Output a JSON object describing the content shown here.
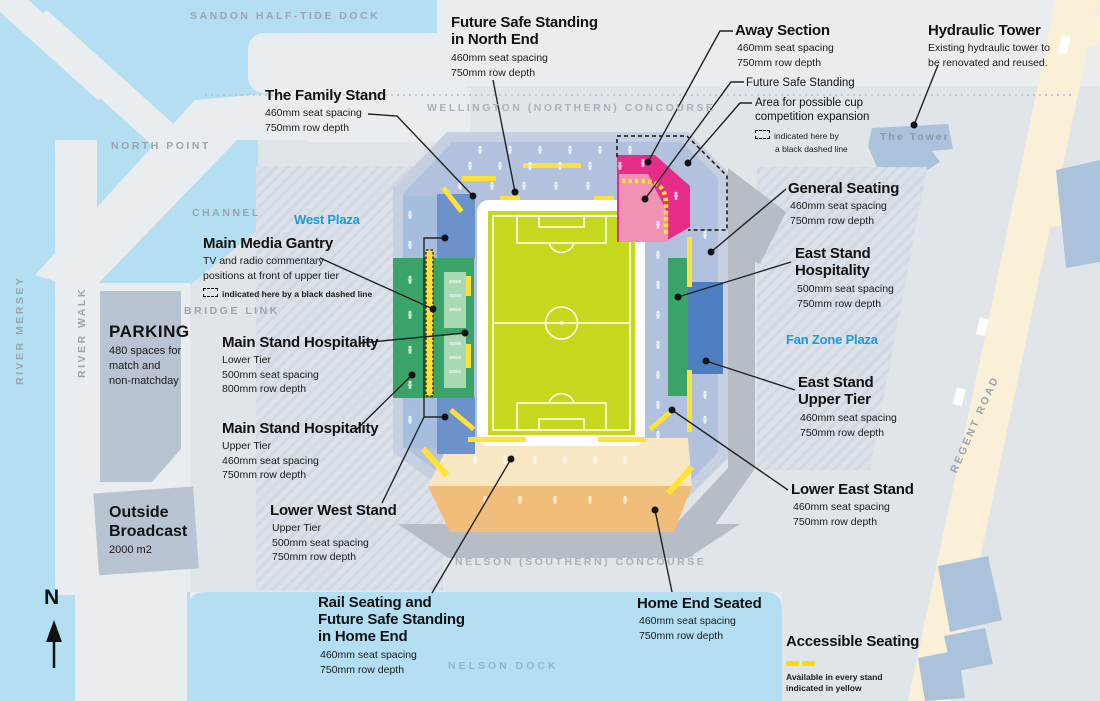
{
  "map_labels": {
    "sandon_dock": "SANDON HALF-TIDE DOCK",
    "north_point": "NORTH POINT",
    "channel": "CHANNEL",
    "bridge_link": "BRIDGE LINK",
    "river_mersey": "RIVER MERSEY",
    "river_walk": "RIVER WALK",
    "wellington_concourse": "WELLINGTON (NORTHERN) CONCOURSE",
    "nelson_concourse": "NELSON (SOUTHERN) CONCOURSE",
    "nelson_dock": "NELSON DOCK",
    "the_tower": "The Tower",
    "regent_road": "REGENT ROAD",
    "west_plaza": "West Plaza",
    "fan_zone_plaza": "Fan Zone Plaza",
    "compass_north": "N"
  },
  "callouts": {
    "future_safe_standing_north": {
      "title_lines": [
        "Future Safe Standing",
        "in North End"
      ],
      "details": [
        "460mm seat spacing",
        "750mm row depth"
      ]
    },
    "family_stand": {
      "title_lines": [
        "The Family Stand"
      ],
      "details": [
        "460mm seat spacing",
        "750mm row depth"
      ]
    },
    "away_section": {
      "title_lines": [
        "Away Section"
      ],
      "details": [
        "460mm seat spacing",
        "750mm row depth"
      ]
    },
    "future_safe_standing": {
      "title_lines": [
        "Future Safe Standing"
      ]
    },
    "cup_expansion": {
      "title_lines": [
        "Area for possible cup",
        "competition expansion"
      ],
      "note_lines": [
        "indicated here by",
        "a black dashed line"
      ]
    },
    "hydraulic_tower": {
      "title_lines": [
        "Hydraulic Tower"
      ],
      "details": [
        "Existing hydraulic tower to",
        "be renovated and reused."
      ]
    },
    "general_seating": {
      "title_lines": [
        "General Seating"
      ],
      "details": [
        "460mm seat spacing",
        "750mm row depth"
      ]
    },
    "east_stand_hospitality": {
      "title_lines": [
        "East Stand",
        "Hospitality"
      ],
      "details": [
        "500mm seat spacing",
        "750mm row depth"
      ]
    },
    "east_stand_upper": {
      "title_lines": [
        "East Stand",
        "Upper Tier"
      ],
      "details": [
        "460mm seat spacing",
        "750mm row depth"
      ]
    },
    "lower_east_stand": {
      "title_lines": [
        "Lower East Stand"
      ],
      "details": [
        "460mm seat spacing",
        "750mm row depth"
      ]
    },
    "accessible_seating": {
      "title_lines": [
        "Accessible Seating"
      ],
      "note_lines": [
        "Available in every stand",
        "indicated in yellow"
      ]
    },
    "home_end_seated": {
      "title_lines": [
        "Home End Seated"
      ],
      "details": [
        "460mm seat spacing",
        "750mm row depth"
      ]
    },
    "rail_seating": {
      "title_lines": [
        "Rail Seating and",
        "Future Safe Standing",
        "in Home End"
      ],
      "details": [
        "460mm seat spacing",
        "750mm row depth"
      ]
    },
    "lower_west_stand": {
      "title_lines": [
        "Lower West Stand"
      ],
      "details": [
        "Upper Tier",
        "500mm seat spacing",
        "750mm row depth"
      ]
    },
    "main_stand_hospitality_lower": {
      "title_lines": [
        "Main Stand Hospitality"
      ],
      "details": [
        "Lower Tier",
        "500mm seat spacing",
        "800mm row depth"
      ]
    },
    "main_stand_hospitality_upper": {
      "title_lines": [
        "Main Stand Hospitality"
      ],
      "details": [
        "Upper Tier",
        "460mm seat spacing",
        "750mm row depth"
      ]
    },
    "main_media_gantry": {
      "title_lines": [
        "Main Media Gantry"
      ],
      "details": [
        "TV and radio commentary",
        "positions at front of upper tier"
      ],
      "note_lines": [
        "indicated here by a black dashed line"
      ]
    },
    "parking": {
      "title_lines": [
        "PARKING"
      ],
      "details": [
        "480 spaces for",
        "match and",
        "non-matchday"
      ]
    },
    "outside_broadcast": {
      "title_lines": [
        "Outside",
        "Broadcast"
      ],
      "details": [
        "2000 m2"
      ]
    }
  },
  "colors": {
    "water": "#b4dff2",
    "site": "#e0e5e9",
    "concourse_ring": "#c6d0e0",
    "general_seating": "#b2c2de",
    "upper_tier_blue": "#6b92ca",
    "east_upper_blue": "#4d7fc0",
    "hospitality_green": "#3aa468",
    "hospitality_light_green": "#a8d8b4",
    "away_magenta": "#e62d87",
    "away_pink": "#f091b6",
    "home_peach": "#f9e6c3",
    "home_orange": "#f0bd7b",
    "accessible_yellow": "#ffe235",
    "pitch_green": "#c5d81d",
    "road_cream": "#faf0d8",
    "parking_gray": "#b9c4d2",
    "building_blue": "#abc3da",
    "podium_gray": "#b7bdc5",
    "plaza_label_blue": "#1a9bd7",
    "map_text_gray": "#9aa5ae"
  }
}
